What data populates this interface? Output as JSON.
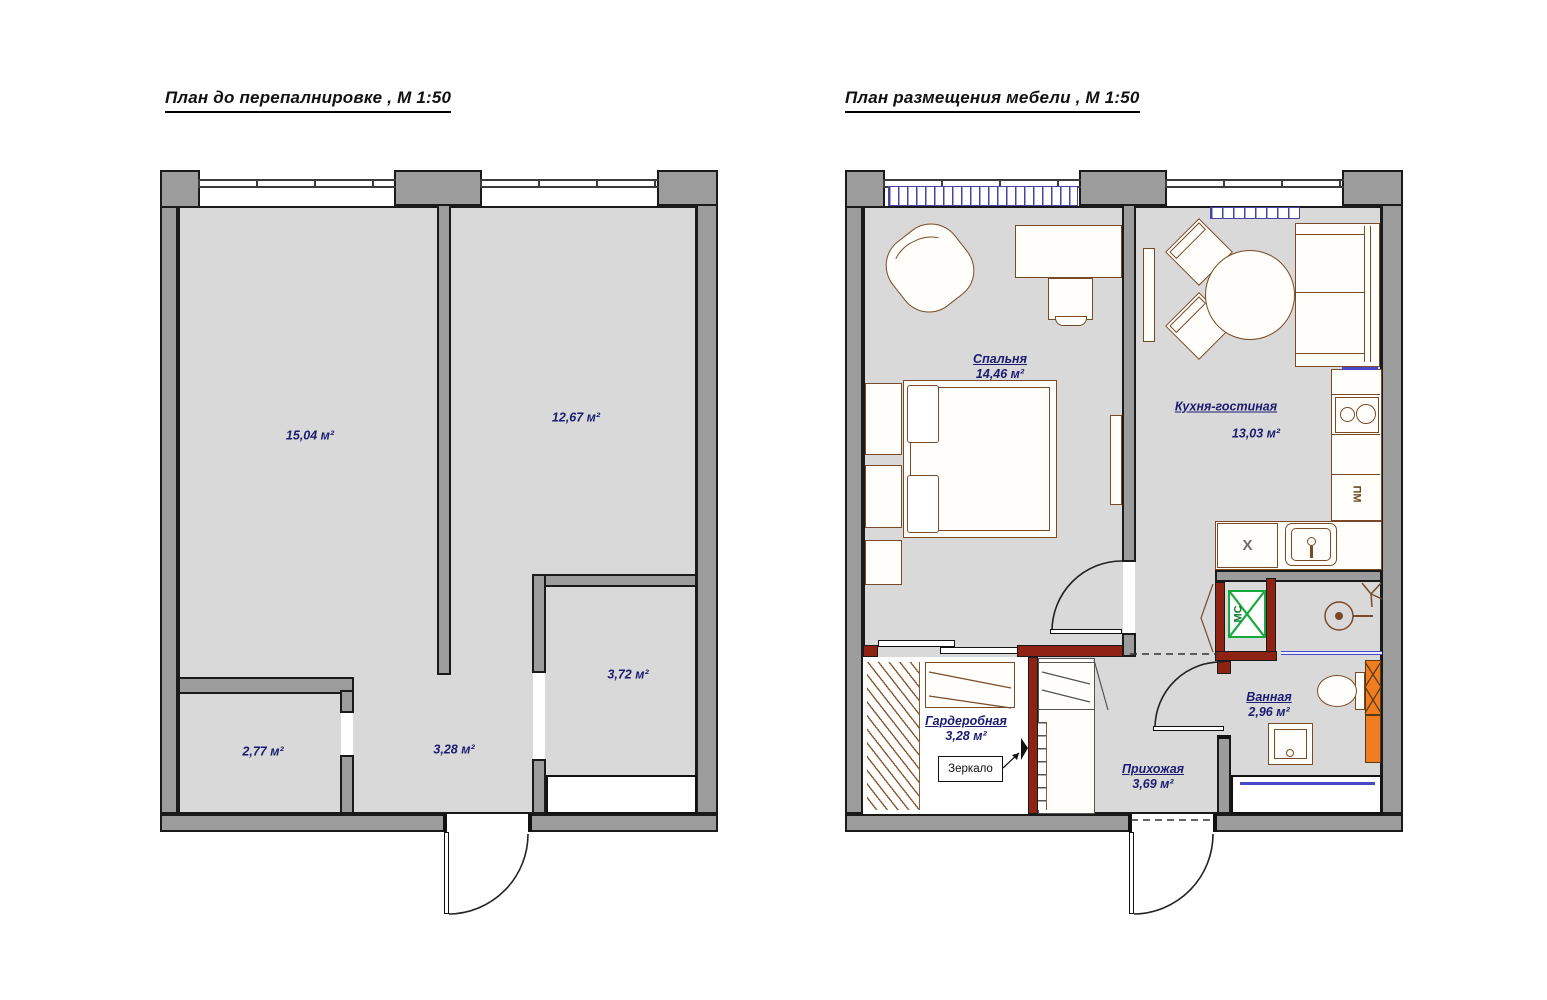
{
  "titles": {
    "left": "План до перепалнировке , М 1:50",
    "right": "План размещения мебели , М 1:50"
  },
  "left_plan": {
    "rooms": [
      {
        "id": "room-large-left",
        "area": "15,04 м²"
      },
      {
        "id": "room-large-right",
        "area": "12,67 м²"
      },
      {
        "id": "room-small-right",
        "area": "3,72 м²"
      },
      {
        "id": "room-small-left",
        "area": "2,77 м²"
      },
      {
        "id": "hallway",
        "area": "3,28 м²"
      }
    ]
  },
  "right_plan": {
    "rooms": [
      {
        "name": "Спальня",
        "area": "14,46 м²"
      },
      {
        "name": "Кухня-гостиная",
        "area": "13,03 м²"
      },
      {
        "name": "Гардеробная",
        "area": "3,28 м²"
      },
      {
        "name": "Прихожая",
        "area": "3,69 м²"
      },
      {
        "name": "Ванная",
        "area": "2,96 м²"
      }
    ],
    "annotations": {
      "mirror": "Зеркало",
      "dishwasher": "ПМ",
      "fridge": "Х",
      "washer": "МС"
    }
  },
  "colors": {
    "wall_gray": "#9c9c9c",
    "new_wall_red": "#8e2213",
    "floor_gray": "#d9d9d9",
    "label_navy": "#1b1b72",
    "furniture_brown": "#7a4a28",
    "accent_green": "#17a93c",
    "accent_orange": "#f07d22",
    "window_blue": "#4848c8"
  }
}
